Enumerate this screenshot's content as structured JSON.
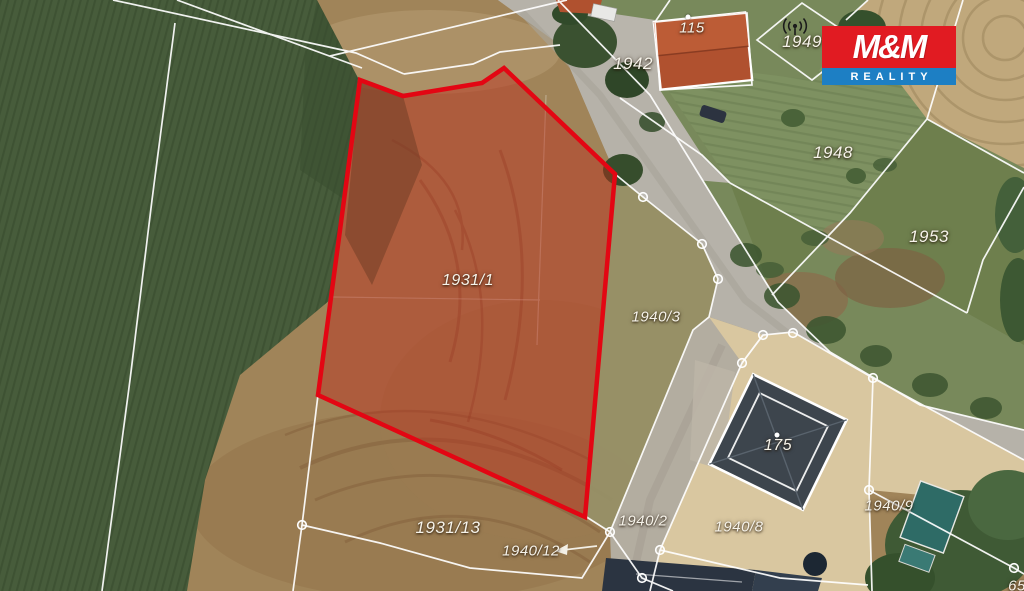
{
  "map": {
    "highlighted_parcel": {
      "number": "1931/1",
      "outline_color": "#e30613",
      "fill_color": "rgba(190,42,26,0.44)"
    },
    "parcel_labels": [
      {
        "text": "115",
        "x": 692,
        "y": 28,
        "size": 15
      },
      {
        "text": "1942",
        "x": 633,
        "y": 64,
        "size": 17
      },
      {
        "text": "1949",
        "x": 802,
        "y": 42,
        "size": 17
      },
      {
        "text": "1948",
        "x": 833,
        "y": 153,
        "size": 17
      },
      {
        "text": "1953",
        "x": 929,
        "y": 237,
        "size": 17
      },
      {
        "text": "1931/1",
        "x": 468,
        "y": 281,
        "size": 16
      },
      {
        "text": "1940/3",
        "x": 656,
        "y": 317,
        "size": 15
      },
      {
        "text": "175",
        "x": 778,
        "y": 446,
        "size": 16
      },
      {
        "text": "1940/2",
        "x": 643,
        "y": 521,
        "size": 15
      },
      {
        "text": "1940/8",
        "x": 739,
        "y": 527,
        "size": 15
      },
      {
        "text": "1940/9",
        "x": 889,
        "y": 506,
        "size": 15
      },
      {
        "text": "1931/13",
        "x": 448,
        "y": 528,
        "size": 17
      },
      {
        "text": "1940/12",
        "x": 531,
        "y": 551,
        "size": 15
      },
      {
        "text": "65",
        "x": 1017,
        "y": 586,
        "size": 15
      }
    ],
    "reference_dots": [
      {
        "x": 688,
        "y": 17
      },
      {
        "x": 777,
        "y": 435
      }
    ],
    "pointer_arrow": {
      "note": "left-arrow next to 1940/12"
    },
    "antenna_icon_parcel": "1949"
  },
  "logo": {
    "title": "M&M",
    "subtitle": "REALITY",
    "top_bg": "#e11b22",
    "bottom_bg": "#1d7fc4"
  }
}
